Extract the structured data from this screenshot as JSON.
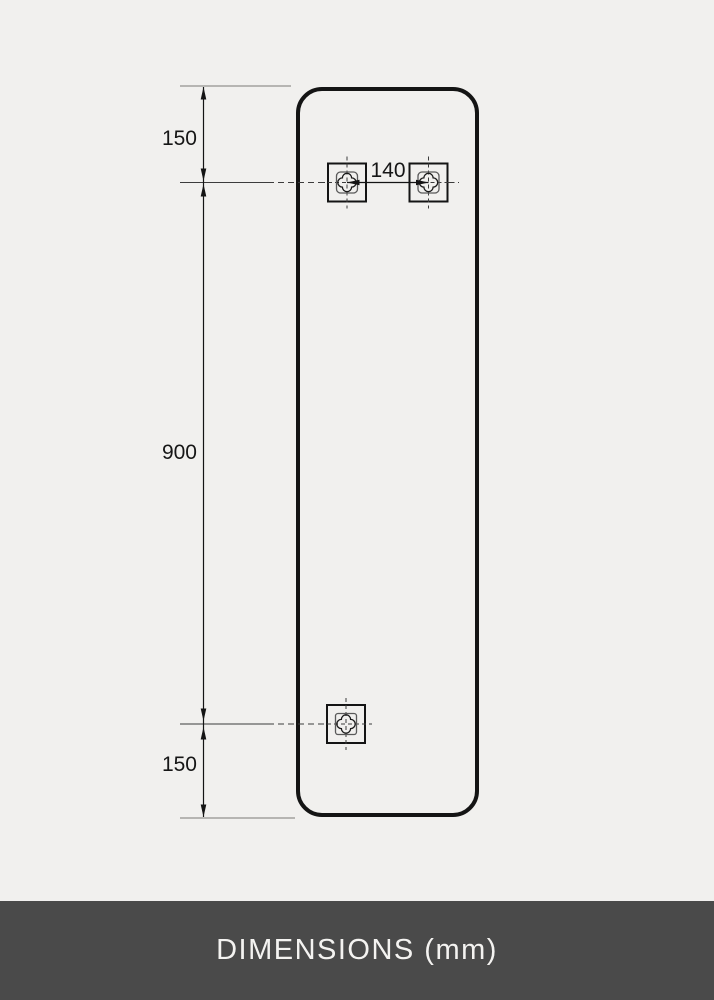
{
  "drawing": {
    "dims": {
      "top_offset": "150",
      "height": "900",
      "bottom_offset": "150",
      "bracket_spacing": "140"
    },
    "icons": {
      "mounting_bracket": "quatrefoil-crosshair-bracket-icon"
    },
    "colors": {
      "background": "#f1f0ee",
      "panel_outline": "#141414",
      "dimension_line": "#141414",
      "extension_line": "#a3a19e",
      "centerline": "#3c3c3c"
    }
  },
  "footer": {
    "label": "DIMENSIONS (mm)",
    "background": "#4a4a4a",
    "text_color": "#f4f3f1"
  }
}
